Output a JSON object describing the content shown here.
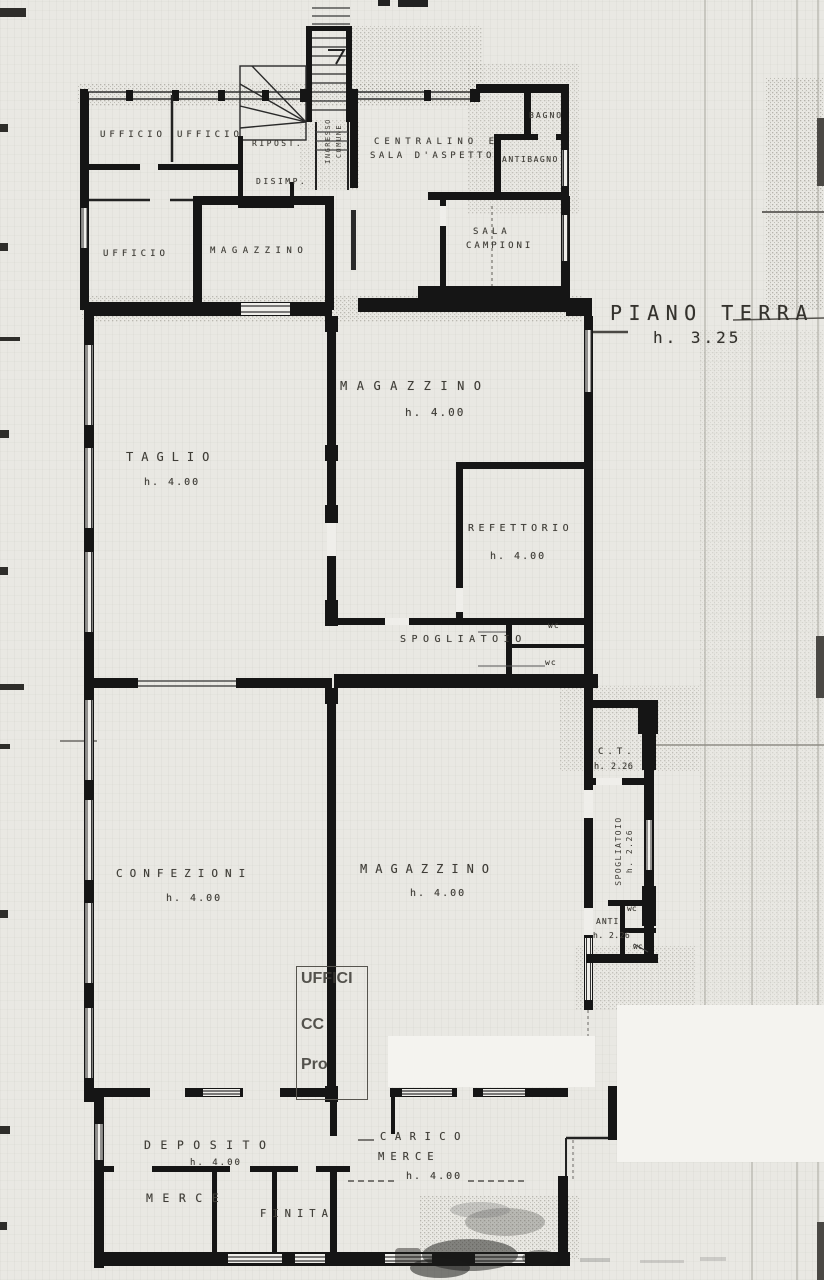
{
  "plan": {
    "title": "PIANO TERRA",
    "title_height": "h. 3.25"
  },
  "labels": {
    "ufficio_a": "UFFICIO",
    "ufficio_b": "UFFICIO",
    "ripostiglio": "RIPOST.",
    "ingresso_1": "INGRESSO",
    "ingresso_2": "COMUNE",
    "disimpegno": "DISIMP.",
    "centralino_1": "CENTRALINO E",
    "centralino_2": "SALA D'ASPETTO",
    "bagno": "BAGNO",
    "antibagno": "ANTIBAGNO",
    "ufficio_c": "UFFICIO",
    "magazzino_uffici": "MAGAZZINO",
    "sala_campioni_1": "SALA",
    "sala_campioni_2": "CAMPIONI",
    "magazzino_1": "MAGAZZINO",
    "magazzino_1_h": "h. 4.00",
    "taglio": "TAGLIO",
    "taglio_h": "h. 4.00",
    "refettorio": "REFETTORIO",
    "refettorio_h": "h. 4.00",
    "spogliatoio_1": "SPOGLIATOIO",
    "wc_1": "wc",
    "wc_2": "wc",
    "ct": "C.T.",
    "ct_h": "h. 2.26",
    "spogliatoio_2": "SPOGLIATOIO",
    "spogliatoio_2_h": "h. 2.26",
    "anti": "ANTI",
    "anti_h": "h. 2.26",
    "wc_3": "wc",
    "wc_4": "wc",
    "confezioni": "CONFEZIONI",
    "confezioni_h": "h. 4.00",
    "magazzino_2": "MAGAZZINO",
    "magazzino_2_h": "h. 4.00",
    "stamp_1": "UFFICI",
    "stamp_2": "CC",
    "stamp_3": "Pro",
    "deposito": "DEPOSITO",
    "deposito_h": "h. 4.00",
    "carico_1": "CARICO",
    "carico_2": "MERCE",
    "carico_h": "h. 4.00",
    "merce": "MERCE",
    "finita": "FINITA"
  },
  "colors": {
    "paper": "#e9e8e3",
    "ink": "#151515",
    "pencil": "#3f3d37"
  }
}
